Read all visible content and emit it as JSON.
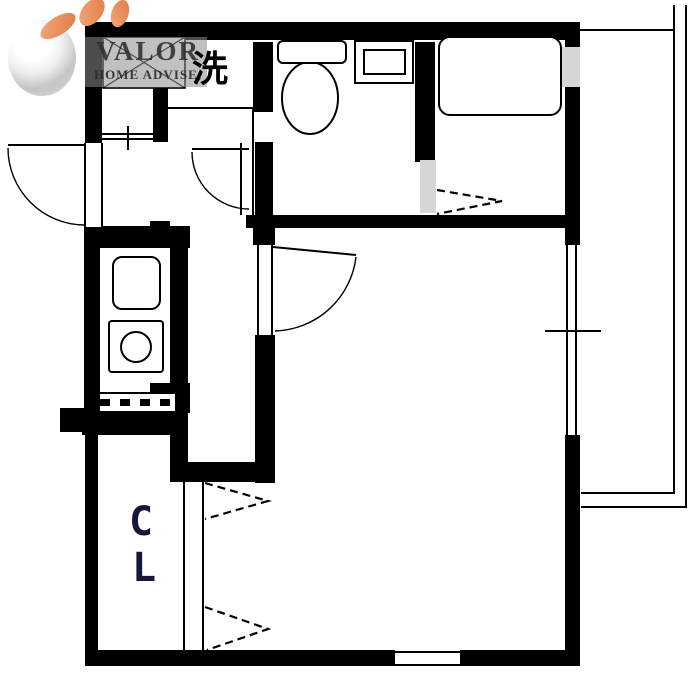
{
  "branding": {
    "name": "VALOR",
    "tagline": "HOME ADVISE,",
    "accent_color": "#e98f63",
    "panel_color": "#8c8c8c",
    "text_color": "#2d2d2d"
  },
  "labels": {
    "laundry": "洗",
    "closet_line1": "C",
    "closet_line2": "L"
  },
  "palette": {
    "wall": "#000000",
    "background": "#ffffff",
    "fixture_shade": "#d6d6d6"
  }
}
